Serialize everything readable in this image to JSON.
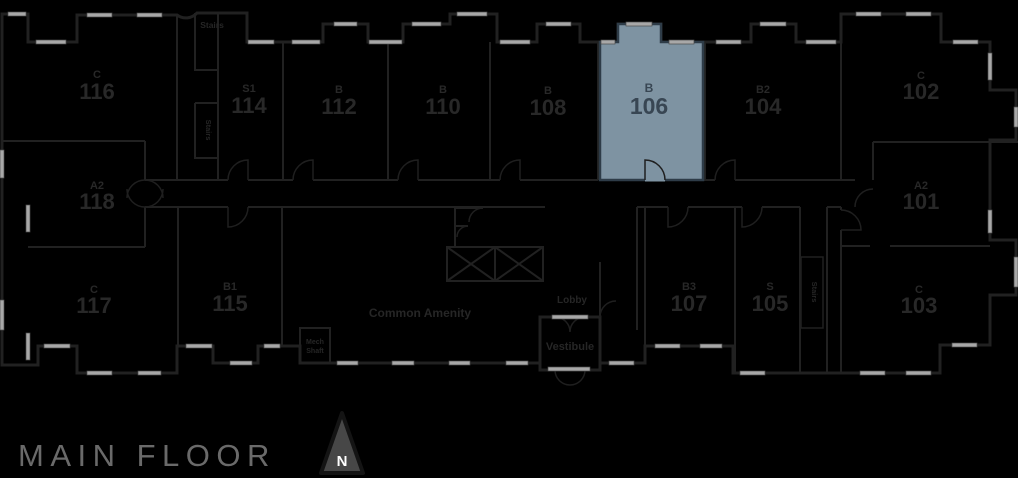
{
  "title": "MAIN FLOOR",
  "compass": {
    "label": "N"
  },
  "highlighted_unit": "106",
  "colors": {
    "background": "#000000",
    "walls": "#212121",
    "windows": "#a8a8a8",
    "highlight_fill": "#7e93a2",
    "highlight_text": "#384653",
    "label_text": "#282828",
    "title_text": "#6a6a6a",
    "compass_fill": "#474747",
    "compass_letter": "#ffffff"
  },
  "rooms": {
    "r116": {
      "type": "C",
      "number": "116"
    },
    "r114": {
      "type": "S1",
      "number": "114"
    },
    "r112": {
      "type": "B",
      "number": "112"
    },
    "r110": {
      "type": "B",
      "number": "110"
    },
    "r108": {
      "type": "B",
      "number": "108"
    },
    "r106": {
      "type": "B",
      "number": "106"
    },
    "r104": {
      "type": "B2",
      "number": "104"
    },
    "r102": {
      "type": "C",
      "number": "102"
    },
    "r118": {
      "type": "A2",
      "number": "118"
    },
    "r101": {
      "type": "A2",
      "number": "101"
    },
    "r117": {
      "type": "C",
      "number": "117"
    },
    "r115": {
      "type": "B1",
      "number": "115"
    },
    "r107": {
      "type": "B3",
      "number": "107"
    },
    "r105": {
      "type": "S",
      "number": "105"
    },
    "r103": {
      "type": "C",
      "number": "103"
    }
  },
  "labels": {
    "stairs_top": "Stairs",
    "stairs_left": "Stairs",
    "stairs_right": "Stairs",
    "mech_line1": "Mech",
    "mech_line2": "Shaft",
    "common_amenity": "Common Amenity",
    "lobby": "Lobby",
    "vestibule": "Vestibule"
  }
}
